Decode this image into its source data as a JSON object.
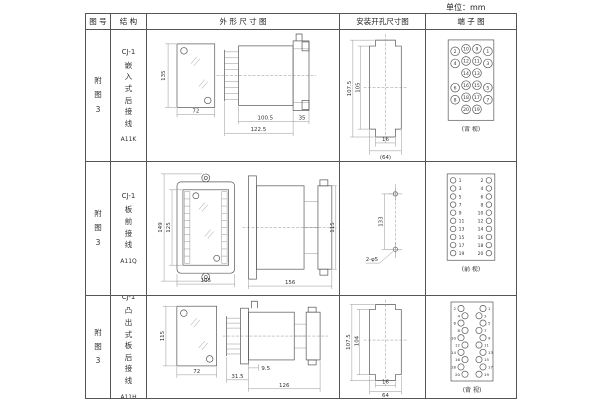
{
  "unit_label": "单位：mm",
  "headers": {
    "fig_no": "图 号",
    "structure": "结 构",
    "outline": "外 形 尺 寸 图",
    "install": "安装开孔尺寸图",
    "terminal": "端 子 图"
  },
  "rows": [
    {
      "fig_no": "附图3",
      "model": "CJ-1",
      "structure_name": "嵌入式后接线",
      "code": "A11K",
      "outline": {
        "height": "135",
        "width": "72",
        "body": "100.5",
        "total": "122.5",
        "flange": "35"
      },
      "install": {
        "outer": "107.5",
        "inner": "105",
        "slot": "16",
        "span": "(64)"
      },
      "terminal_caption": "(背 视)"
    },
    {
      "fig_no": "附图3",
      "model": "CJ-1",
      "structure_name": "板前接线",
      "code": "A11Q",
      "outline": {
        "height": "149",
        "inner_height": "125",
        "width": "105",
        "length": "156",
        "side_height": "115"
      },
      "install": {
        "pitch": "133",
        "holes": "2-φ5"
      },
      "terminal_caption": "(前 视)"
    },
    {
      "fig_no": "附图3",
      "model": "CJ-1",
      "structure_name": "凸出式板后接线",
      "code": "A11H",
      "outline": {
        "height": "115",
        "width": "72",
        "pins": "31.5",
        "offset": "9.5",
        "length": "126"
      },
      "install": {
        "outer": "107.5",
        "inner": "104",
        "slot": "16",
        "span": "64"
      },
      "terminal_caption": "(背 视)"
    }
  ],
  "terminals": {
    "back_grid": [
      [
        "2",
        "10",
        "9",
        "1"
      ],
      [
        "4",
        "12",
        "11",
        "3"
      ],
      [
        "",
        "14",
        "13",
        ""
      ],
      [
        "6",
        "16",
        "15",
        "5"
      ],
      [
        "8",
        "18",
        "17",
        "7"
      ],
      [
        "",
        "20",
        "19",
        ""
      ]
    ],
    "front_cols": {
      "left": [
        "1",
        "3",
        "5",
        "7",
        "9",
        "11",
        "13",
        "15",
        "17",
        "19"
      ],
      "right": [
        "2",
        "4",
        "6",
        "8",
        "10",
        "12",
        "14",
        "16",
        "18",
        "20"
      ]
    },
    "back_cols": {
      "left": [
        "2",
        "4",
        "6",
        "8",
        "10",
        "12",
        "14",
        "16",
        "18",
        "20"
      ],
      "right": [
        "1",
        "3",
        "5",
        "7",
        "9",
        "11",
        "13",
        "15",
        "17",
        "19"
      ]
    }
  }
}
